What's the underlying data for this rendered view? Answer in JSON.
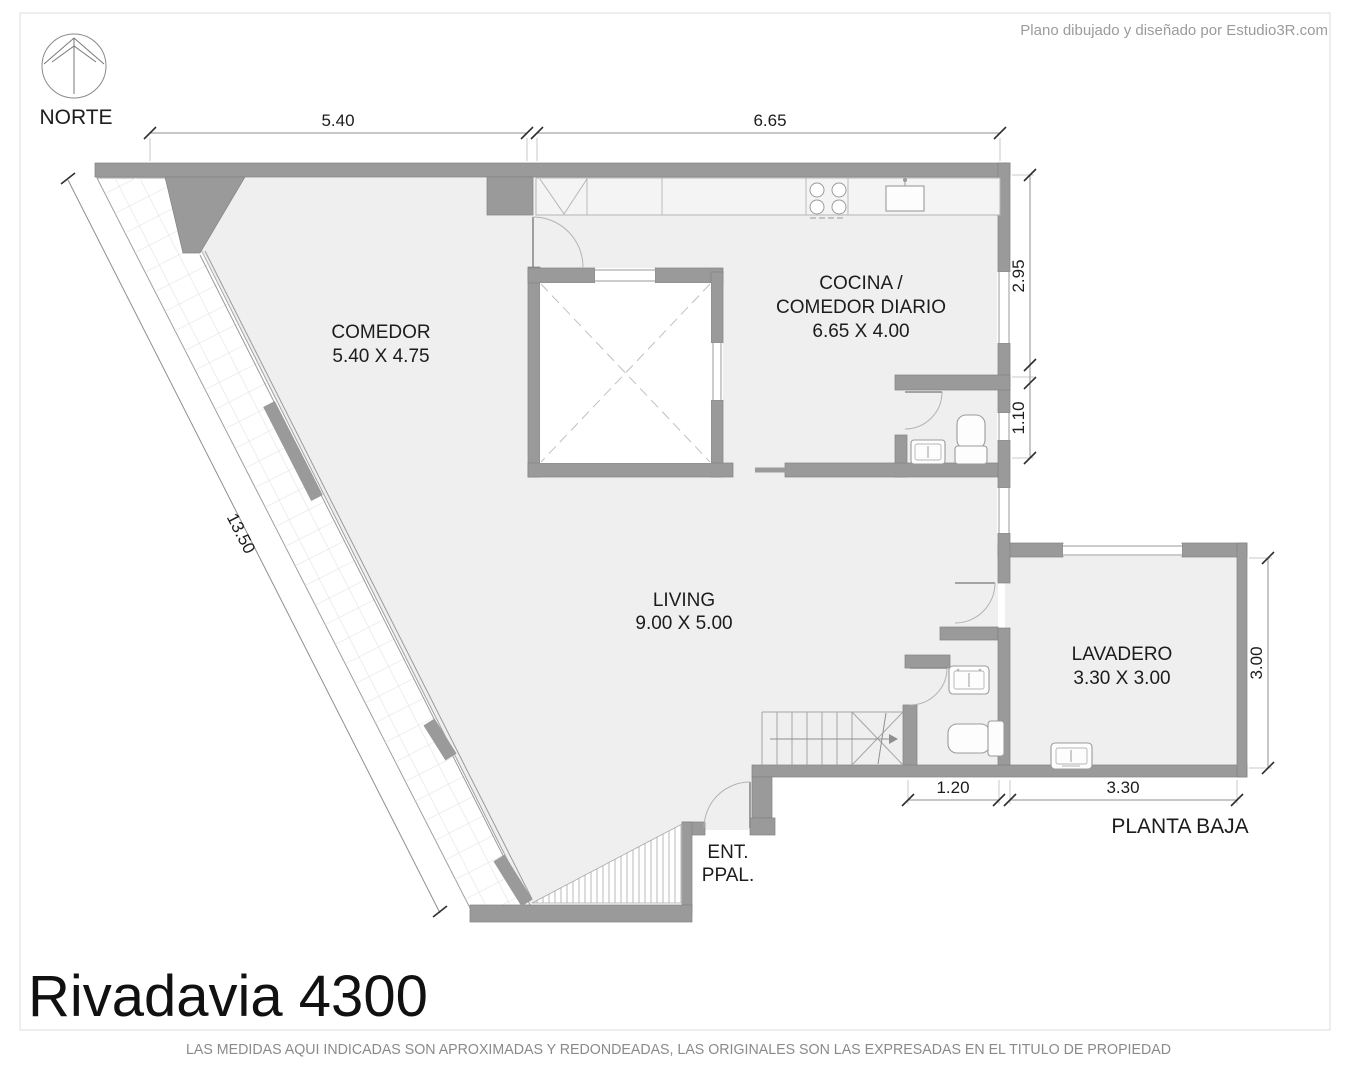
{
  "credit": "Plano dibujado y diseñado por Estudio3R.com",
  "north": {
    "label": "NORTE"
  },
  "title": "Rivadavia 4300",
  "plan_label": "PLANTA BAJA",
  "entrance": {
    "line1": "ENT.",
    "line2": "PPAL."
  },
  "footer": "LAS MEDIDAS AQUI INDICADAS SON APROXIMADAS Y REDONDEADAS, LAS ORIGINALES SON LAS EXPRESADAS EN EL TITULO DE PROPIEDAD",
  "rooms": {
    "comedor": {
      "name": "COMEDOR",
      "size": "5.40 X 4.75"
    },
    "cocina": {
      "name_line1": "COCINA /",
      "name_line2": "COMEDOR DIARIO",
      "size": "6.65 X 4.00"
    },
    "living": {
      "name": "LIVING",
      "size": "9.00 X 5.00"
    },
    "lavadero": {
      "name": "LAVADERO",
      "size": "3.30 X 3.00"
    }
  },
  "dimensions": {
    "top_comedor": "5.40",
    "top_cocina": "6.65",
    "right_cocina": "2.95",
    "right_bath": "1.10",
    "terrace_diagonal": "13.50",
    "lavadero_height": "3.00",
    "bottom_bath": "1.20",
    "bottom_lavadero": "3.30"
  },
  "colors": {
    "wall": "#9a9a9a",
    "floor": "#efefef",
    "terrace_grid": "#e4e4e4",
    "frame": "#dddddd"
  }
}
